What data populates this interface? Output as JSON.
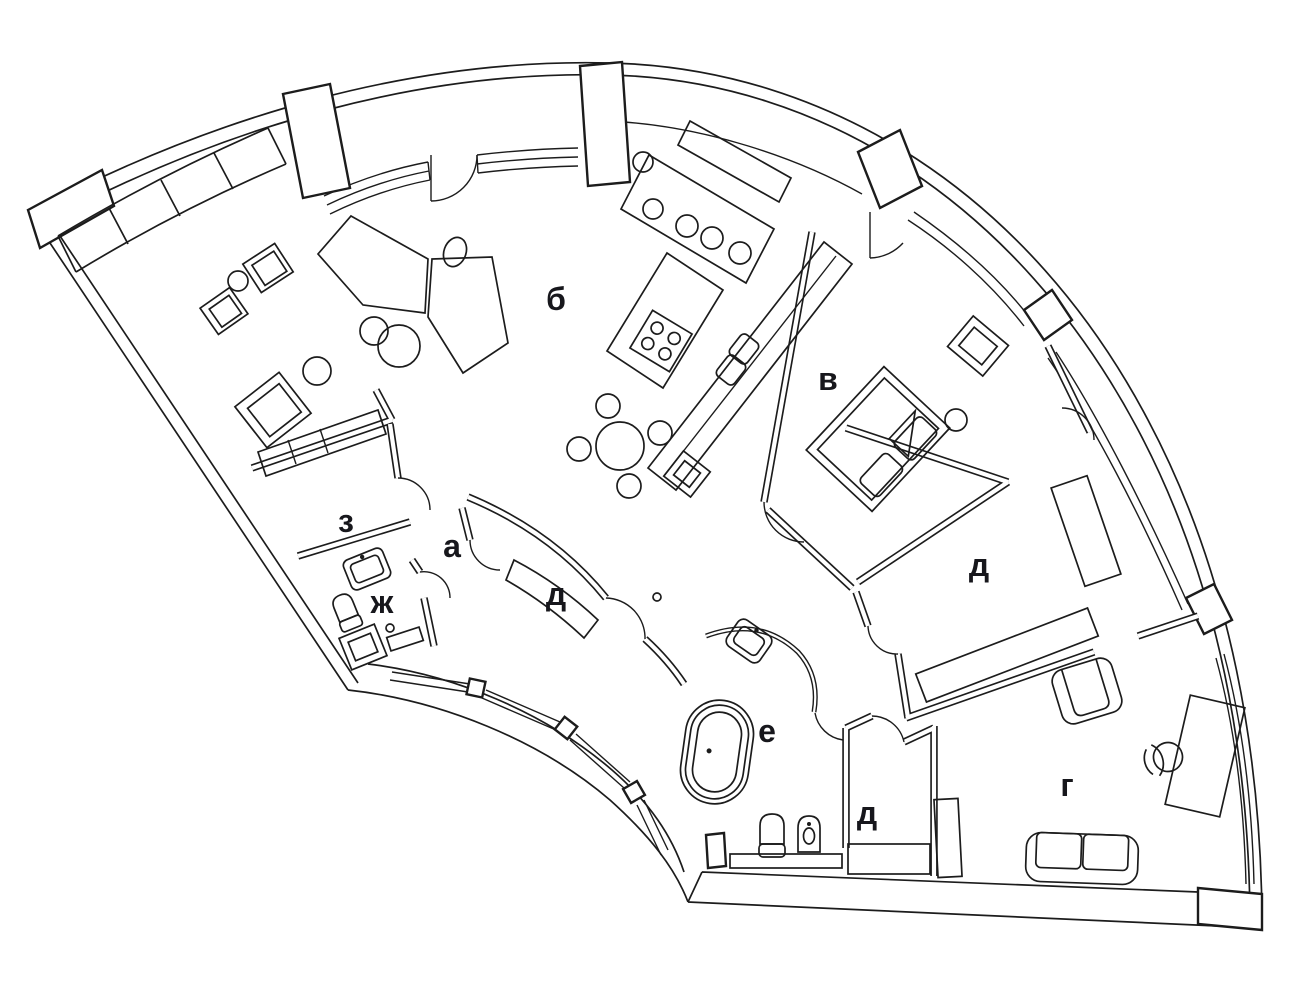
{
  "figure": {
    "kind": "floor-plan",
    "style": "black line drawing on white"
  },
  "palette": {
    "background": "#ffffff",
    "line": "#1c1c1c",
    "label": "#17171c"
  },
  "rooms": [
    {
      "id": "b",
      "label": "б"
    },
    {
      "id": "v",
      "label": "в"
    },
    {
      "id": "z",
      "label": "з"
    },
    {
      "id": "a",
      "label": "а"
    },
    {
      "id": "zh",
      "label": "ж"
    },
    {
      "id": "d-hall",
      "label": "д"
    },
    {
      "id": "d-bedroom",
      "label": "д"
    },
    {
      "id": "e",
      "label": "е"
    },
    {
      "id": "d-small",
      "label": "д"
    },
    {
      "id": "g",
      "label": "г"
    }
  ]
}
